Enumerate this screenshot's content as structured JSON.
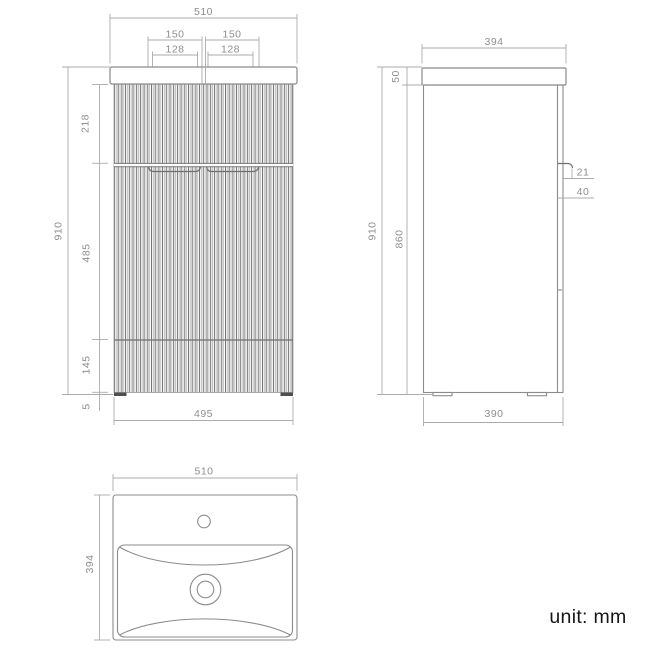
{
  "unit_note": "unit: mm",
  "front_view": {
    "overall_width": "510",
    "handle_pitch_left": "150",
    "handle_pitch_right": "150",
    "handle_cutout_left": "128",
    "handle_cutout_right": "128",
    "overall_height": "910",
    "top_drawer_height": "218",
    "bottom_drawer_height": "485",
    "base_panel_height": "145",
    "foot_height": "5",
    "body_width": "495"
  },
  "side_view": {
    "overall_depth": "394",
    "worktop_thickness": "50",
    "overall_height": "910",
    "cabinet_height": "860",
    "handle_projection": "21",
    "handle_drop": "40",
    "body_depth": "390"
  },
  "basin_view": {
    "basin_width": "510",
    "basin_depth": "394"
  },
  "colors": {
    "background": "#ffffff",
    "object_line": "#8c8c8c",
    "dimension_line": "#ababab",
    "dimension_text": "#8e8e8e",
    "note_text": "#161616"
  }
}
